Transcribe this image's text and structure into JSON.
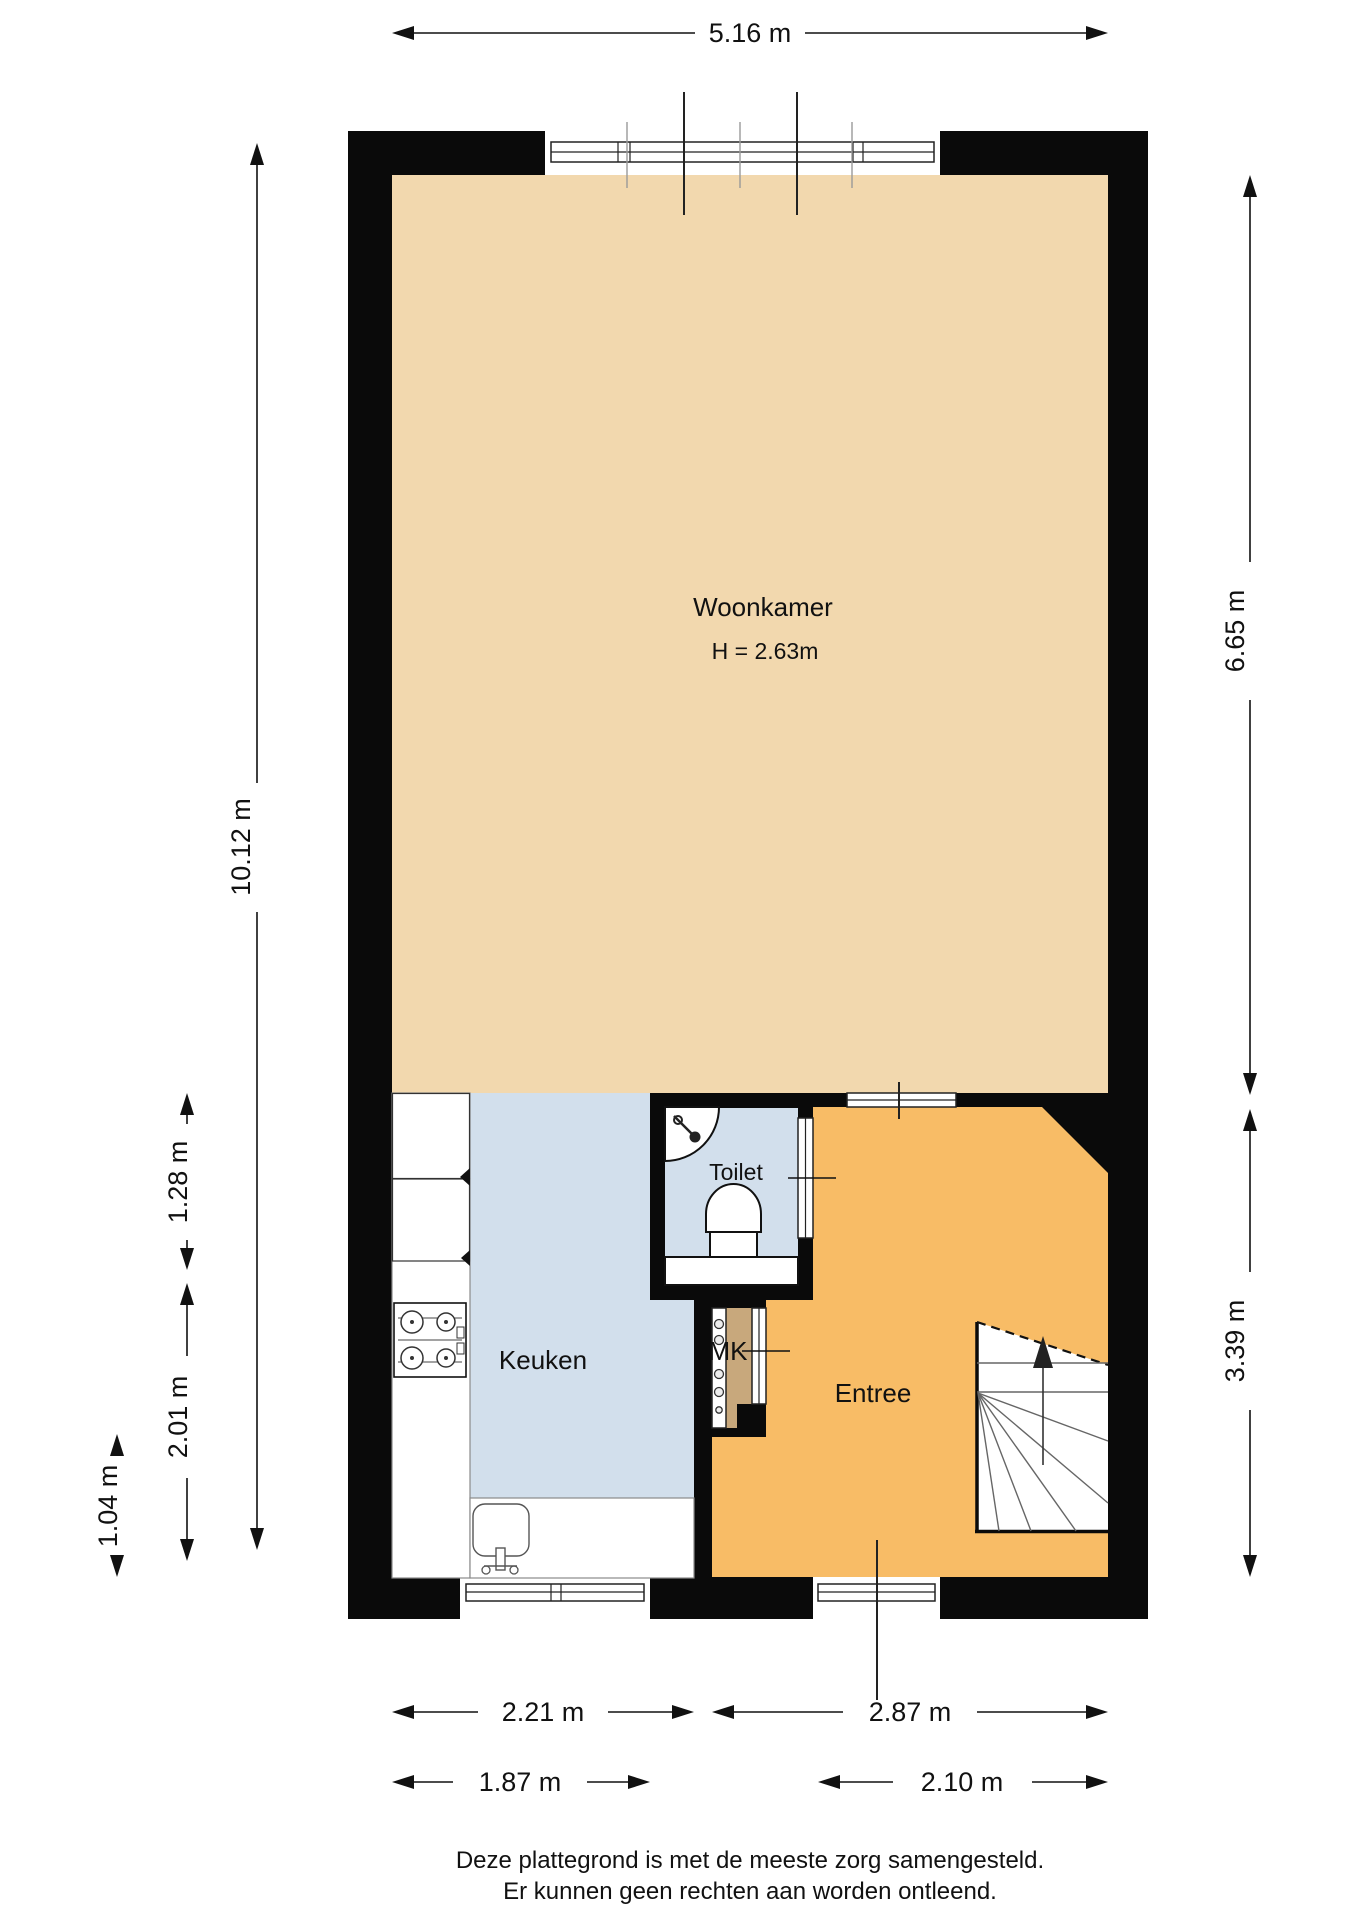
{
  "rooms": {
    "woonkamer": {
      "label": "Woonkamer",
      "height_note": "H = 2.63m"
    },
    "keuken": {
      "label": "Keuken"
    },
    "toilet": {
      "label": "Toilet"
    },
    "entree": {
      "label": "Entree"
    },
    "mk": {
      "label": "MK"
    }
  },
  "dimensions": {
    "top_width": "5.16 m",
    "left_total": "10.12 m",
    "left_kitchen_upper": "1.28 m",
    "left_kitchen_lower": "2.01 m",
    "left_counter": "1.04 m",
    "right_woonkamer": "6.65 m",
    "right_entree": "3.39 m",
    "bottom_kitchen": "2.21 m",
    "bottom_entree": "2.87 m",
    "bottom_kitchen_window": "1.87 m",
    "bottom_entree_window": "2.10 m"
  },
  "footer": {
    "line1": "Deze plattegrond is met de meeste zorg samengesteld.",
    "line2": "Er kunnen geen rechten aan worden ontleend."
  },
  "colors": {
    "woonkamer": "#F2D8AE",
    "entree": "#F8BC66",
    "wet": "#D2DFEC",
    "mk": "#C8A87C",
    "wall": "#0A0A0A",
    "tread": "#666666",
    "counter_stroke": "#8A8A8A"
  }
}
